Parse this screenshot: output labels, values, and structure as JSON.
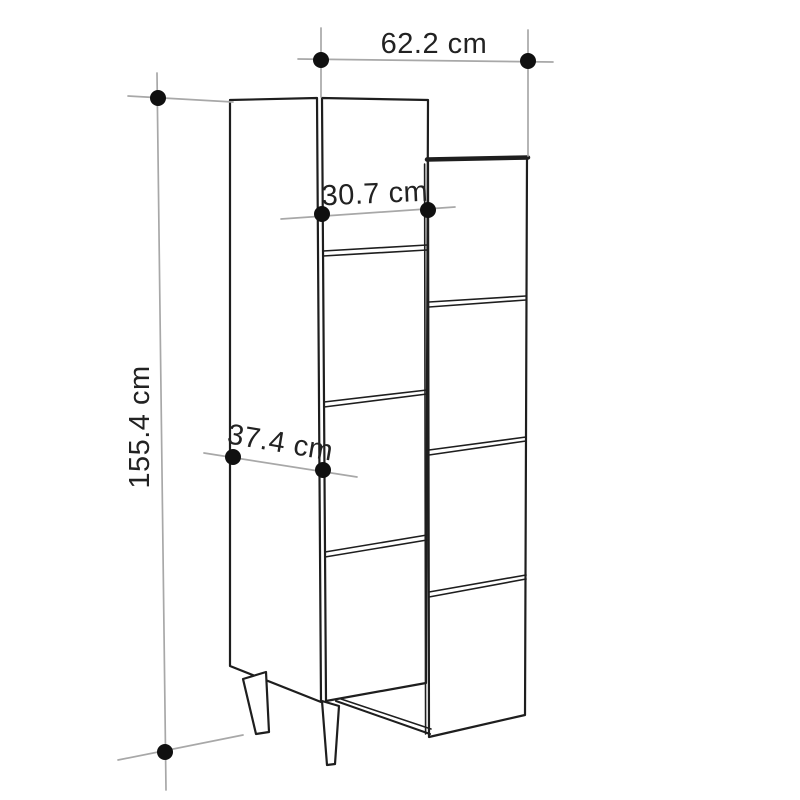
{
  "canvas": {
    "width_px": 800,
    "height_px": 800
  },
  "colors": {
    "page_background": "#ffffff",
    "artwork_line": "#1e1e1e",
    "dimension_line": "#a8a8a8",
    "dimension_dot": "#101010",
    "label_text": "#222222"
  },
  "diagram": {
    "subject": "tall-cabinet-dimension-drawing",
    "dimensions": {
      "total_width": "62.2 cm",
      "total_height": "155.4 cm",
      "front_width": "30.7 cm",
      "depth": "37.4 cm"
    }
  }
}
